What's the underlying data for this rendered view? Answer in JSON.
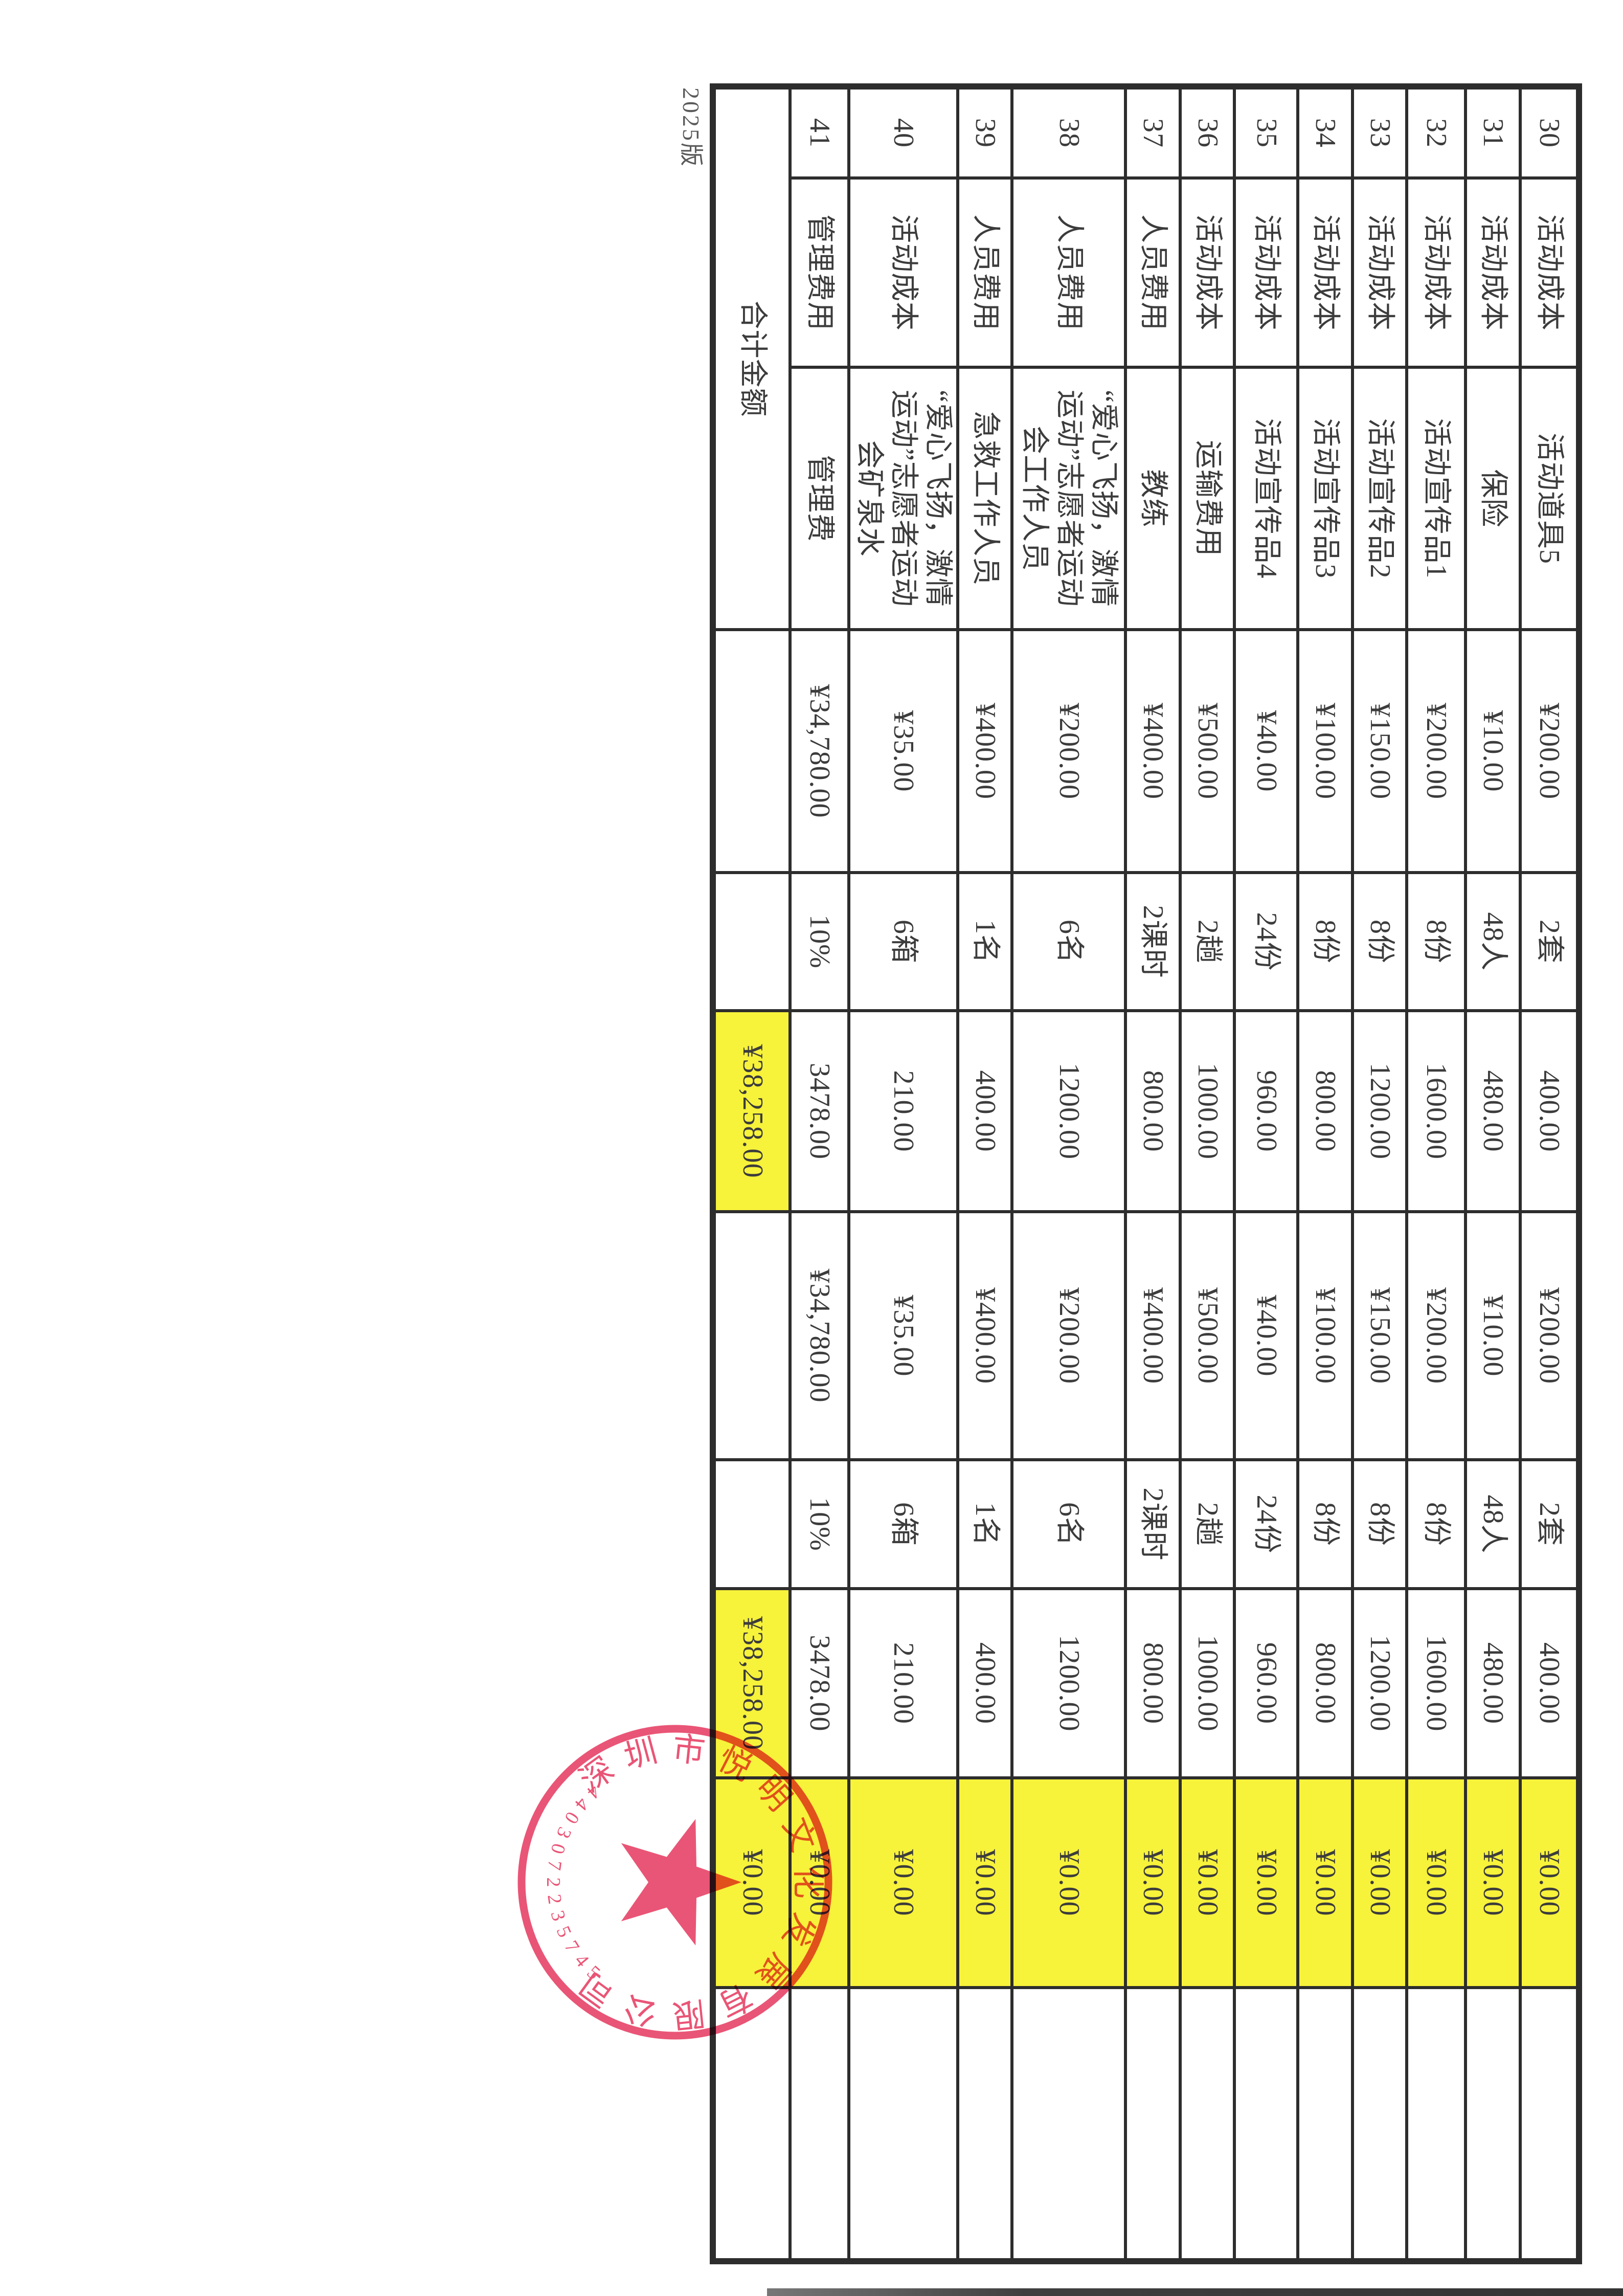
{
  "version_label": "2025版",
  "colors": {
    "highlight": "#f7f23a",
    "stamp_red": "#e8486b",
    "table_line": "#2d2d2d",
    "text_ink": "#3c3c3c"
  },
  "table": {
    "rows": [
      {
        "no": "30",
        "category": "活动成本",
        "item": "活动道具5",
        "budget_price": "¥200.00",
        "budget_qty": "2套",
        "budget_amount": "400.00",
        "final_price": "¥200.00",
        "final_qty": "2套",
        "final_amount": "400.00",
        "diff": "¥0.00",
        "note": ""
      },
      {
        "no": "31",
        "category": "活动成本",
        "item": "保险",
        "budget_price": "¥10.00",
        "budget_qty": "48人",
        "budget_amount": "480.00",
        "final_price": "¥10.00",
        "final_qty": "48人",
        "final_amount": "480.00",
        "diff": "¥0.00",
        "note": ""
      },
      {
        "no": "32",
        "category": "活动成本",
        "item": "活动宣传品1",
        "budget_price": "¥200.00",
        "budget_qty": "8份",
        "budget_amount": "1600.00",
        "final_price": "¥200.00",
        "final_qty": "8份",
        "final_amount": "1600.00",
        "diff": "¥0.00",
        "note": ""
      },
      {
        "no": "33",
        "category": "活动成本",
        "item": "活动宣传品2",
        "budget_price": "¥150.00",
        "budget_qty": "8份",
        "budget_amount": "1200.00",
        "final_price": "¥150.00",
        "final_qty": "8份",
        "final_amount": "1200.00",
        "diff": "¥0.00",
        "note": ""
      },
      {
        "no": "34",
        "category": "活动成本",
        "item": "活动宣传品3",
        "budget_price": "¥100.00",
        "budget_qty": "8份",
        "budget_amount": "800.00",
        "final_price": "¥100.00",
        "final_qty": "8份",
        "final_amount": "800.00",
        "diff": "¥0.00",
        "note": ""
      },
      {
        "no": "35",
        "category": "活动成本",
        "item": "活动宣传品4",
        "budget_price": "¥40.00",
        "budget_qty": "24份",
        "budget_amount": "960.00",
        "final_price": "¥40.00",
        "final_qty": "24份",
        "final_amount": "960.00",
        "diff": "¥0.00",
        "note": ""
      },
      {
        "no": "36",
        "category": "活动成本",
        "item": "运输费用",
        "budget_price": "¥500.00",
        "budget_qty": "2趟",
        "budget_amount": "1000.00",
        "final_price": "¥500.00",
        "final_qty": "2趟",
        "final_amount": "1000.00",
        "diff": "¥0.00",
        "note": ""
      },
      {
        "no": "37",
        "category": "人员费用",
        "item": "教练",
        "budget_price": "¥400.00",
        "budget_qty": "2课时",
        "budget_amount": "800.00",
        "final_price": "¥400.00",
        "final_qty": "2课时",
        "final_amount": "800.00",
        "diff": "¥0.00",
        "note": ""
      },
      {
        "no": "38",
        "category": "人员费用",
        "item": "“爱心飞扬，激情运动”志愿者运动会工作人员",
        "budget_price": "¥200.00",
        "budget_qty": "6名",
        "budget_amount": "1200.00",
        "final_price": "¥200.00",
        "final_qty": "6名",
        "final_amount": "1200.00",
        "diff": "¥0.00",
        "note": ""
      },
      {
        "no": "39",
        "category": "人员费用",
        "item": "急救工作人员",
        "budget_price": "¥400.00",
        "budget_qty": "1名",
        "budget_amount": "400.00",
        "final_price": "¥400.00",
        "final_qty": "1名",
        "final_amount": "400.00",
        "diff": "¥0.00",
        "note": ""
      },
      {
        "no": "40",
        "category": "活动成本",
        "item": "“爱心飞扬，激情运动”志愿者运动会矿泉水",
        "budget_price": "¥35.00",
        "budget_qty": "6箱",
        "budget_amount": "210.00",
        "final_price": "¥35.00",
        "final_qty": "6箱",
        "final_amount": "210.00",
        "diff": "¥0.00",
        "note": ""
      },
      {
        "no": "41",
        "category": "管理费用",
        "item": "管理费",
        "budget_price": "¥34,780.00",
        "budget_qty": "10%",
        "budget_amount": "3478.00",
        "final_price": "¥34,780.00",
        "final_qty": "10%",
        "final_amount": "3478.00",
        "diff": "¥0.00",
        "note": ""
      }
    ],
    "total": {
      "label": "合计金额",
      "budget_amount": "¥38,258.00",
      "final_amount": "¥38,258.00",
      "diff": "¥0.00"
    }
  },
  "stamp": {
    "company": "深圳市悦明文化发展有限公司",
    "number": "4403072235745"
  }
}
